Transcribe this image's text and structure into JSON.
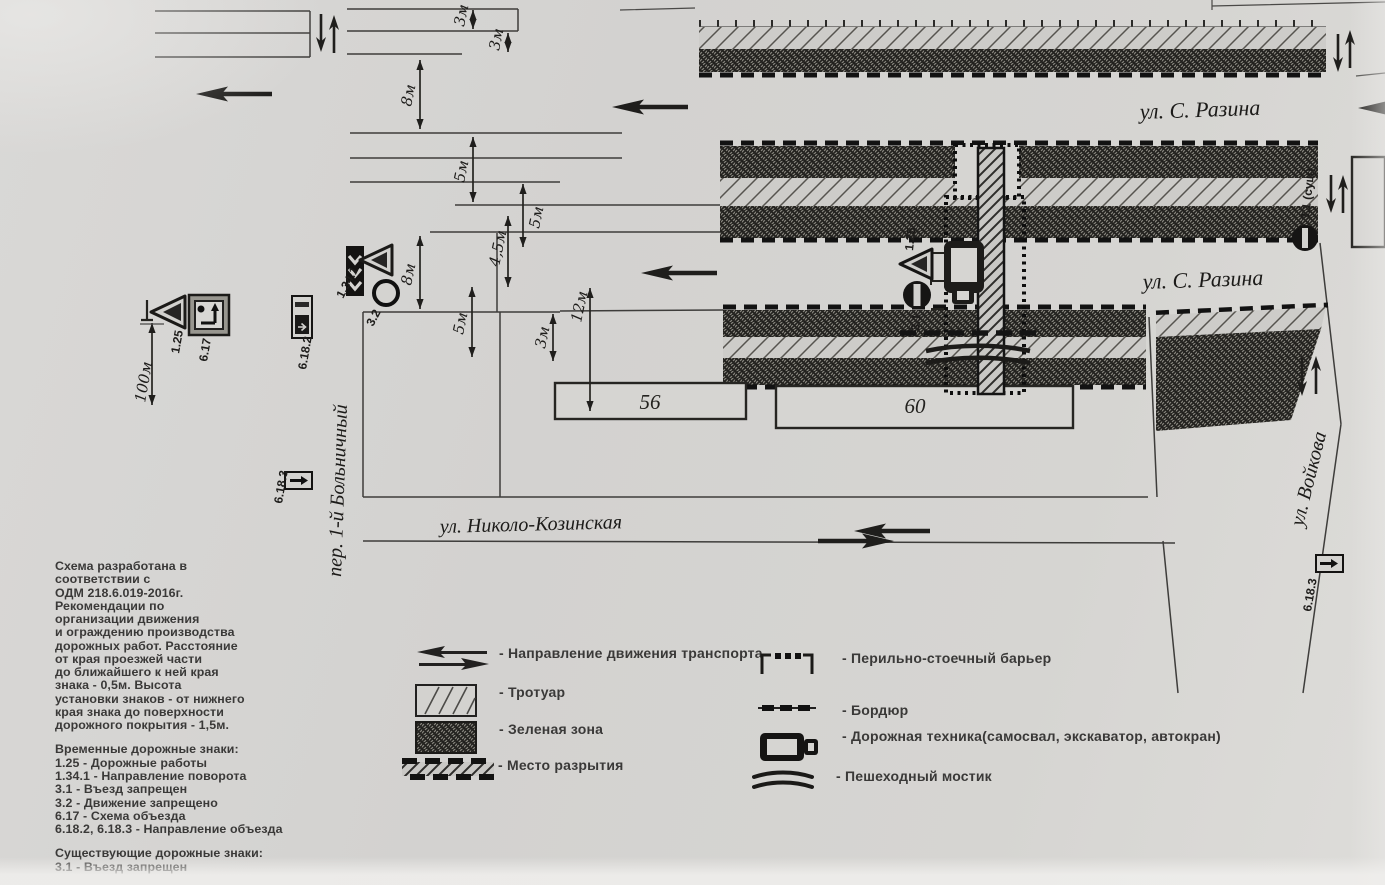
{
  "scheme": {
    "streets": {
      "razina_top": "ул. С. Разина",
      "razina_mid": "ул. С. Разина",
      "nikolo_kozinskaya": "ул. Николо-Козинская",
      "bolnichny": "пер. 1-й Больничный",
      "voykova": "ул. Войкова"
    },
    "buildings": {
      "b56": "56",
      "b60": "60"
    },
    "dimensions": {
      "d3m_1": "3м",
      "d3m_2": "3м",
      "d8m_1": "8м",
      "d5m_1": "5м",
      "d5m_2": "5м",
      "d45m": "4,5м",
      "d8m_2": "8м",
      "d5m_3": "5м",
      "d3m_3": "3м",
      "d12m": "12м",
      "d100m": "100м"
    },
    "sign_labels": {
      "s1341": "1.34.1",
      "s32": "3.2",
      "s125_left": "1.25",
      "s617": "6.17",
      "s6182": "6.18.2",
      "s6183_left": "6.18.3",
      "s125_center": "1.25",
      "s31_center": "3.1",
      "s31_existing": "3.1 (сущ)",
      "s6183_right": "6.18.3"
    }
  },
  "legend": {
    "left": [
      {
        "icon": "traffic-direction-icon",
        "label": "- Направление движения транспорта"
      },
      {
        "icon": "sidewalk-swatch-icon",
        "label": "- Тротуар"
      },
      {
        "icon": "green-zone-swatch-icon",
        "label": "- Зеленая зона"
      },
      {
        "icon": "excavation-swatch-icon",
        "label": "- Место разрытия"
      }
    ],
    "right": [
      {
        "icon": "barrier-icon",
        "label": "- Перильно-стоечный барьер"
      },
      {
        "icon": "curb-icon",
        "label": "- Бордюр"
      },
      {
        "icon": "machinery-icon",
        "label": "- Дорожная техника(самосвал, экскаватор, автокран)"
      },
      {
        "icon": "bridge-icon",
        "label": "- Пешеходный мостик"
      }
    ]
  },
  "notes": {
    "intro": "Схема разработана в\nсоответствии с\nОДМ 218.6.019-2016г.\nРекомендации по\nорганизации движения\nи ограждению производства\nдорожных работ. Расстояние\nот края проезжей части\nдо ближайшего к ней края\nзнака - 0,5м. Высота\nустановки знаков - от нижнего\nкрая знака до поверхности\nдорожного покрытия - 1,5м.",
    "temporary_signs": "Временные дорожные знаки:\n1.25 - Дорожные работы\n1.34.1 - Направление поворота\n3.1 - Въезд запрещен\n3.2 - Движение запрещено\n6.17 - Схема объезда\n6.18.2, 6.18.3 - Направление объезда",
    "existing_signs": "Существующие дорожные знаки:\n3.1 - Въезд запрещен"
  }
}
